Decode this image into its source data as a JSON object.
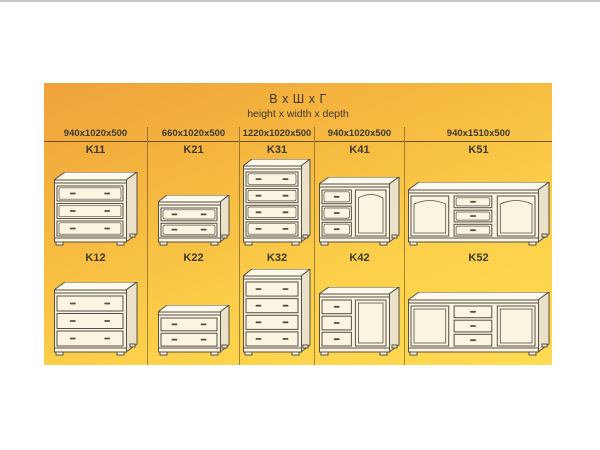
{
  "title": {
    "main": "В х Ш х Г",
    "sub": "height x width x depth"
  },
  "colors": {
    "panel_top": "#efa23b",
    "panel_bottom": "#ffdb52",
    "ink": "#3d3931",
    "rule_line": "#5d5340",
    "cabinet_fill": "#faf4e1",
    "cabinet_top_fill": "#fdf9ec",
    "cabinet_side_fill": "#ebe1c8",
    "cabinet_stroke": "#554f47"
  },
  "columns": [
    {
      "dimensions": "940x1020x500",
      "items": [
        {
          "code": "K11",
          "drawing": {
            "type": "chest-3",
            "style": "paneled"
          }
        },
        {
          "code": "K12",
          "drawing": {
            "type": "chest-3",
            "style": "plain"
          }
        }
      ]
    },
    {
      "dimensions": "660x1020x500",
      "items": [
        {
          "code": "K21",
          "drawing": {
            "type": "chest-2",
            "style": "paneled"
          }
        },
        {
          "code": "K22",
          "drawing": {
            "type": "chest-2",
            "style": "plain"
          }
        }
      ]
    },
    {
      "dimensions": "1220x1020x500",
      "items": [
        {
          "code": "K31",
          "drawing": {
            "type": "chest-4",
            "style": "paneled"
          }
        },
        {
          "code": "K32",
          "drawing": {
            "type": "chest-4",
            "style": "plain"
          }
        }
      ]
    },
    {
      "dimensions": "940x1020x500",
      "items": [
        {
          "code": "K41",
          "drawing": {
            "type": "combo",
            "style": "paneled"
          }
        },
        {
          "code": "K42",
          "drawing": {
            "type": "combo",
            "style": "plain"
          }
        }
      ]
    },
    {
      "dimensions": "940x1510x500",
      "items": [
        {
          "code": "K51",
          "drawing": {
            "type": "sideboard",
            "style": "paneled"
          }
        },
        {
          "code": "K52",
          "drawing": {
            "type": "sideboard",
            "style": "plain"
          }
        }
      ]
    }
  ]
}
